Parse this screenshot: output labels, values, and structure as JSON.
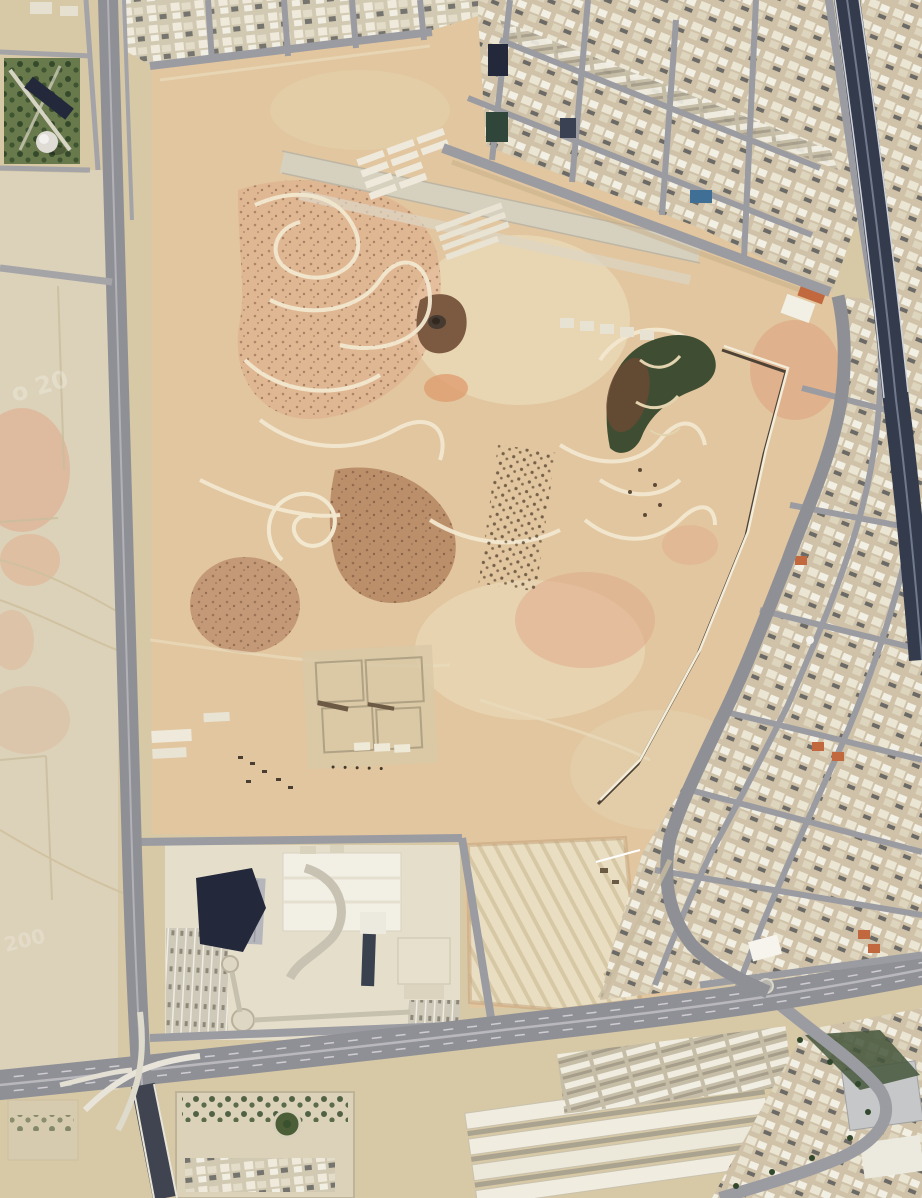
{
  "meta": {
    "kind": "satellite-imagery",
    "width": 922,
    "height": 1198,
    "scene": "Aerial satellite view of a large graded sandy park parcel with winding trails, bordered by a vertical avenue on the west, dense tan city blocks on the north and east, a dark expressway at the northeast edge, a wide boulevard with an interchange at the south, and open desert lots on the west"
  },
  "watermarks": {
    "upper": "o 20",
    "lower": "200"
  },
  "palette": {
    "desert_base": "#d7c8a6",
    "desert_light": "#ddd3bc",
    "parcel_sand": "#e1c69f",
    "parcel_light": "#ead9b8",
    "pink_soil": "#e0a888",
    "brown_soil": "#a87250",
    "dark_mound": "#7c5a42",
    "trail_light": "#f2e8d0",
    "fan_green": "#3f4e33",
    "tree_green": "#2f4527",
    "park_green": "#687a4c",
    "road_gray": "#8f9096",
    "street_gray": "#9b9ba2",
    "highway_dark": "#343b4d",
    "sunken_road": "#3f4450",
    "city_base": "#cfc2a8",
    "building_light": "#ece6d5",
    "building_white": "#f2efe5",
    "building_dark": "#23283a",
    "roof_orange": "#c2683e",
    "pool_blue": "#3f6f94",
    "wall_light": "#f2ecd9",
    "wall_shadow": "#4e4236",
    "excavation_sand": "#e9dec2",
    "median_green": "#44563b"
  },
  "features": {
    "parcel": "large-graded-park-construction-parcel",
    "trails": "winding-light-colored-trails",
    "fan": "dark-green-planted-fan-area",
    "wall": "long-linear-perimeter-wall-with-shadow",
    "runway": "old-runway-strip",
    "ruins": "demolished-building-foundations",
    "excavation": "terraced-excavation-pit",
    "mall": "commercial-complex-with-dark-pyramid-roof",
    "park": "tree-filled-park-block-with-white-dome",
    "interchange": "interchange-with-white-flyover-ramps",
    "compound": "walled-compound-with-green-circle-drive",
    "warehouses": "rows-of-long-white-warehouses"
  }
}
